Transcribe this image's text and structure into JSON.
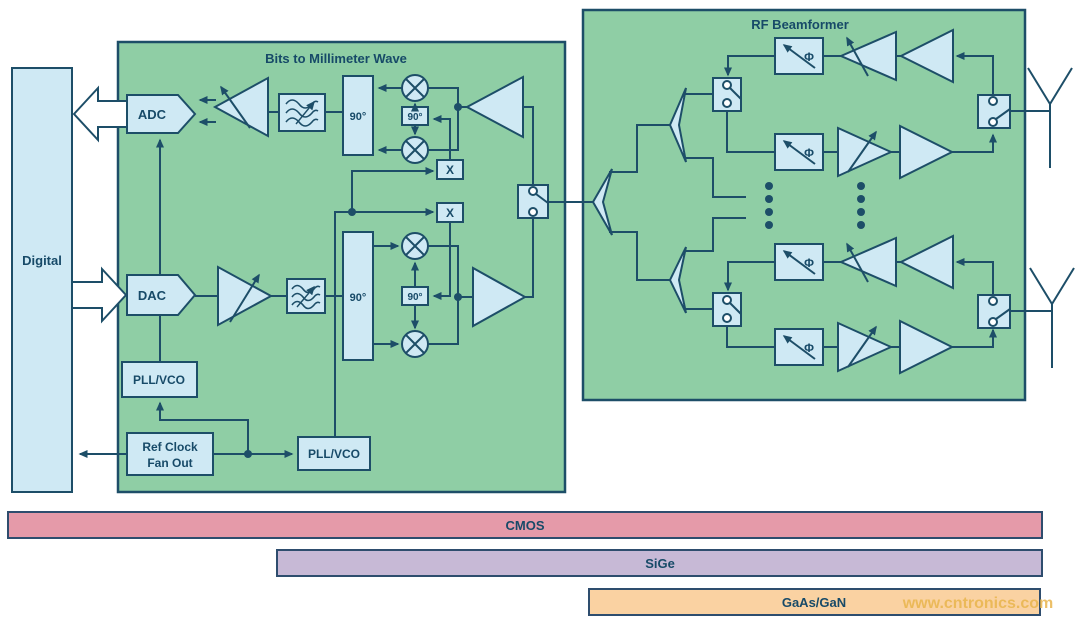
{
  "diagram": {
    "digital": "Digital",
    "bits_box_title": "Bits to Millimeter Wave",
    "rf_box_title": "RF Beamformer",
    "adc": "ADC",
    "dac": "DAC",
    "pll_vco_1": "PLL/VCO",
    "pll_vco_2": "PLL/VCO",
    "ref_clock_line1": "Ref Clock",
    "ref_clock_line2": "Fan Out",
    "quad_90_rx_main": "90°",
    "quad_90_rx_lo": "90°",
    "quad_90_tx_main": "90°",
    "quad_90_tx_lo": "90°",
    "multiplier_rx": "X",
    "multiplier_tx": "X",
    "phase_shifter_symbol": "Φ"
  },
  "tech_bars": {
    "cmos": "CMOS",
    "sige": "SiGe",
    "gaas_gan": "GaAs/GaN"
  },
  "watermark": "www.cntronics.com",
  "colors": {
    "box_green": "#8fcea5",
    "block_fill": "#cfe9f4",
    "outline_navy": "#1d4e68",
    "bar_cmos": "#e59aa9",
    "bar_sige": "#c7b9d6",
    "bar_gaas": "#fad2a2",
    "watermark_gold": "#e9b54d",
    "white_arrow": "#ffffff"
  }
}
